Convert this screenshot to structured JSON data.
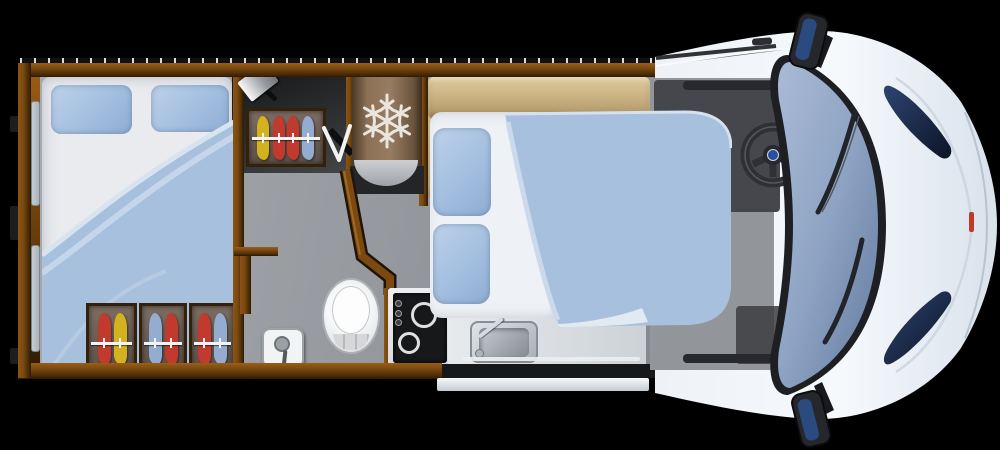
{
  "scene": {
    "type": "motorhome-floorplan-top-view",
    "rooms": [
      "rear-bedroom",
      "dressing-area",
      "bathroom",
      "kitchen",
      "lounge-dinette",
      "drop-down-bed",
      "driver-cab"
    ],
    "fixtures": [
      "rear-double-bed",
      "wardrobe-top",
      "wardrobe-rear-1",
      "wardrobe-rear-2",
      "wardrobe-rear-3",
      "tv",
      "fridge-freezer",
      "dinette-sofa",
      "main-double-bed",
      "toilet",
      "shower-control",
      "hob-two-burner",
      "kitchen-sink",
      "entry-step",
      "steering-wheel",
      "windshield",
      "side-mirror-top",
      "side-mirror-bottom",
      "headlight-top",
      "headlight-bottom",
      "wiper-blades"
    ],
    "wardrobe_clothes": {
      "top": [
        "yellow",
        "red",
        "red",
        "blue"
      ],
      "rear_1": [
        "red",
        "yellow"
      ],
      "rear_2": [
        "blue",
        "red"
      ],
      "rear_3": [
        "red",
        "blue"
      ]
    },
    "icons": [
      "snowflake-icon"
    ]
  },
  "palette": {
    "bg": "#000000",
    "wood": "#7c4a10",
    "wood_dark": "#2f1c04",
    "floor": "#9ba0a6",
    "dark_room": "#2a2c2e",
    "mattress": "#e9ebef",
    "pillow": "#a3bedf",
    "duvet": "#a7c0de",
    "duvet_fold": "#cbd9ec",
    "sheet": "#eef1f5",
    "tan": "#cbb488",
    "cloth_red": "#c23a2e",
    "cloth_yellow": "#d4b21f",
    "cloth_blue": "#93acd0",
    "rail_white": "#f2f3f4",
    "fridge": "#8c7157",
    "snowflake": "#e9e5df",
    "hob": "#17181a",
    "steel": "#c6ccd1",
    "toilet_white": "#eceeef",
    "cab_body": "#eef2f8",
    "glass": "#8ea3c3",
    "glass_deep": "#5f7699",
    "dash": "#45474c",
    "cab_floor": "#92969b",
    "trim_black": "#1b1d1f",
    "badge_blue": "#2a4f9e",
    "lamp_blue": "#1c2c52",
    "red_marker": "#c03a2c",
    "step": "#eff2f5",
    "window_white": "#f7f8f9",
    "window_pane": "#aab4bc"
  }
}
